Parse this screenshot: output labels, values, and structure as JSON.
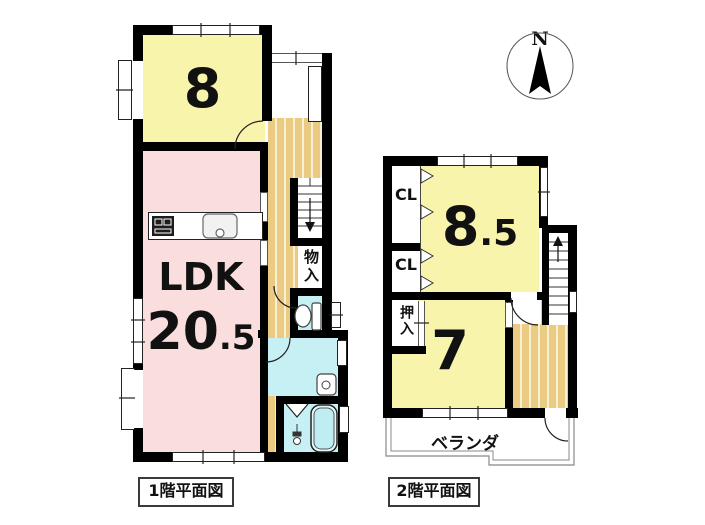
{
  "compass": {
    "north_label": "N"
  },
  "floor1": {
    "caption": "1階平面図",
    "room8_label": "8",
    "ldk_label": "LDK",
    "ldk_size_int": "20",
    "ldk_size_frac": ".5",
    "storage_label": "物入"
  },
  "floor2": {
    "caption": "2階平面図",
    "room85_int": "8",
    "room85_frac": ".5",
    "room7_label": "7",
    "closet1_label": "CL",
    "closet2_label": "CL",
    "oshiire_label": "押入",
    "veranda_label": "ベランダ"
  },
  "colors": {
    "wall": "#000000",
    "room_yellow": "#f8f4ac",
    "ldk_pink": "#fadede",
    "wet_cyan": "#c6f0f4",
    "floor_wood": "#ebcb81"
  }
}
